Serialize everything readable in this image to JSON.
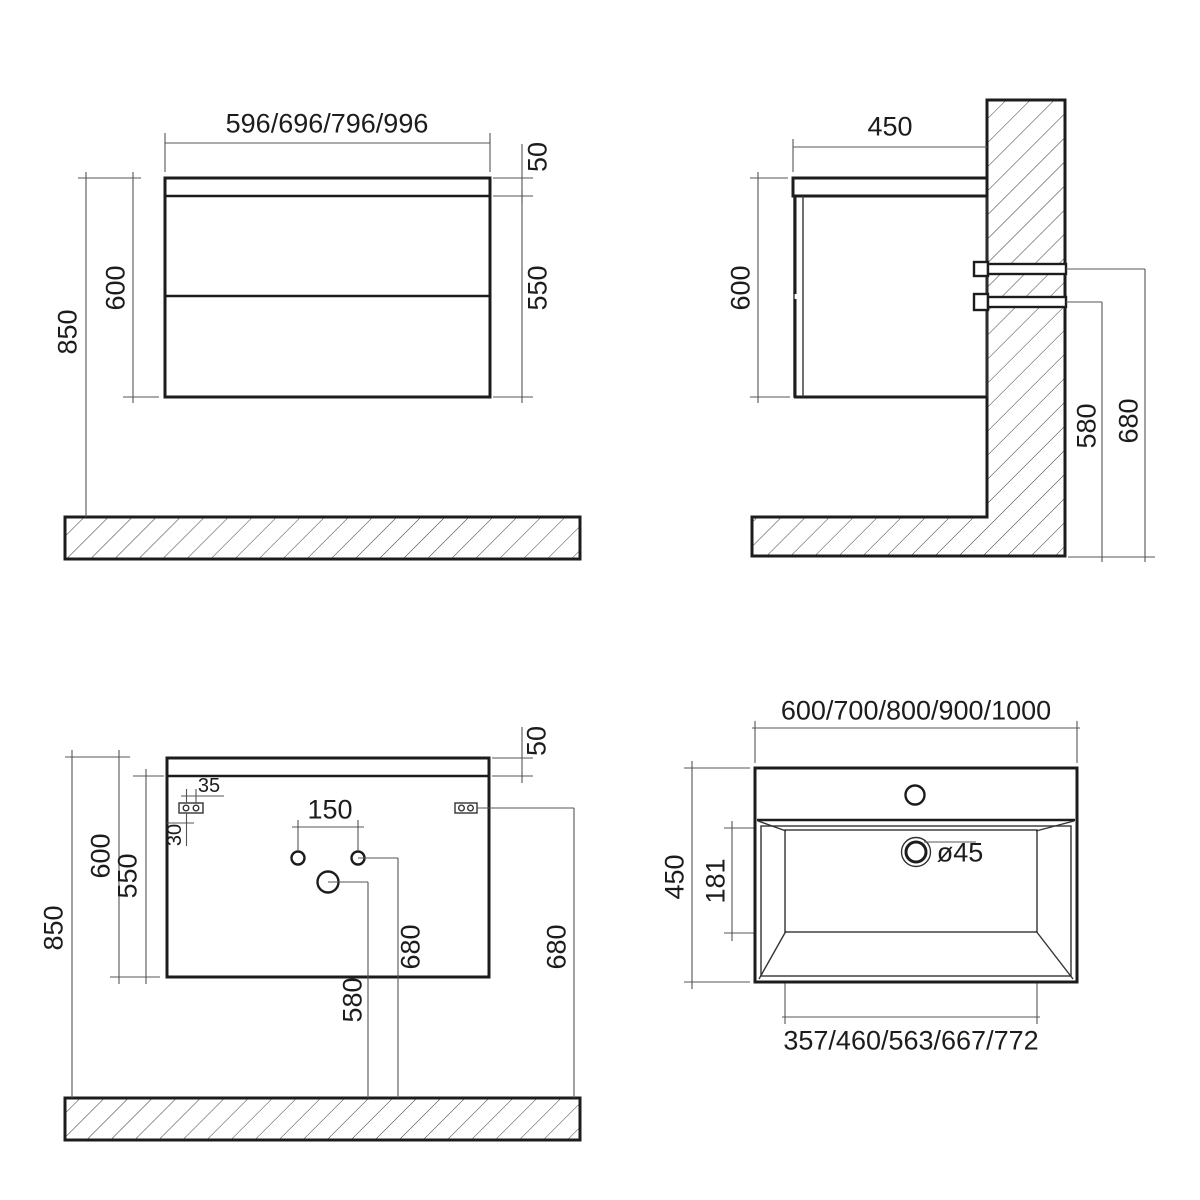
{
  "views": {
    "front": {
      "widths": "596/696/796/996",
      "top_panel": "50",
      "drawer_front": "550",
      "height": "600",
      "install_height": "850"
    },
    "side": {
      "depth": "450",
      "height": "600",
      "upper_bracket_height": "680",
      "lower_bracket_height": "580"
    },
    "back": {
      "install_height": "850",
      "height": "600",
      "drawer_front": "550",
      "top_panel": "50",
      "supply_hole_span": "150",
      "plate_hole_span": "35",
      "plate_offset": "30",
      "supply_hole_height": "680",
      "drain_hole_height": "580",
      "bracket_height": "680"
    },
    "basin": {
      "widths": "600/700/800/900/1000",
      "depth": "450",
      "bowl_depth": "181",
      "drain_diameter": "ø45",
      "bowl_widths": "357/460/563/667/772"
    }
  },
  "colors": {
    "line": "#1c1c1c",
    "background": "#ffffff"
  }
}
